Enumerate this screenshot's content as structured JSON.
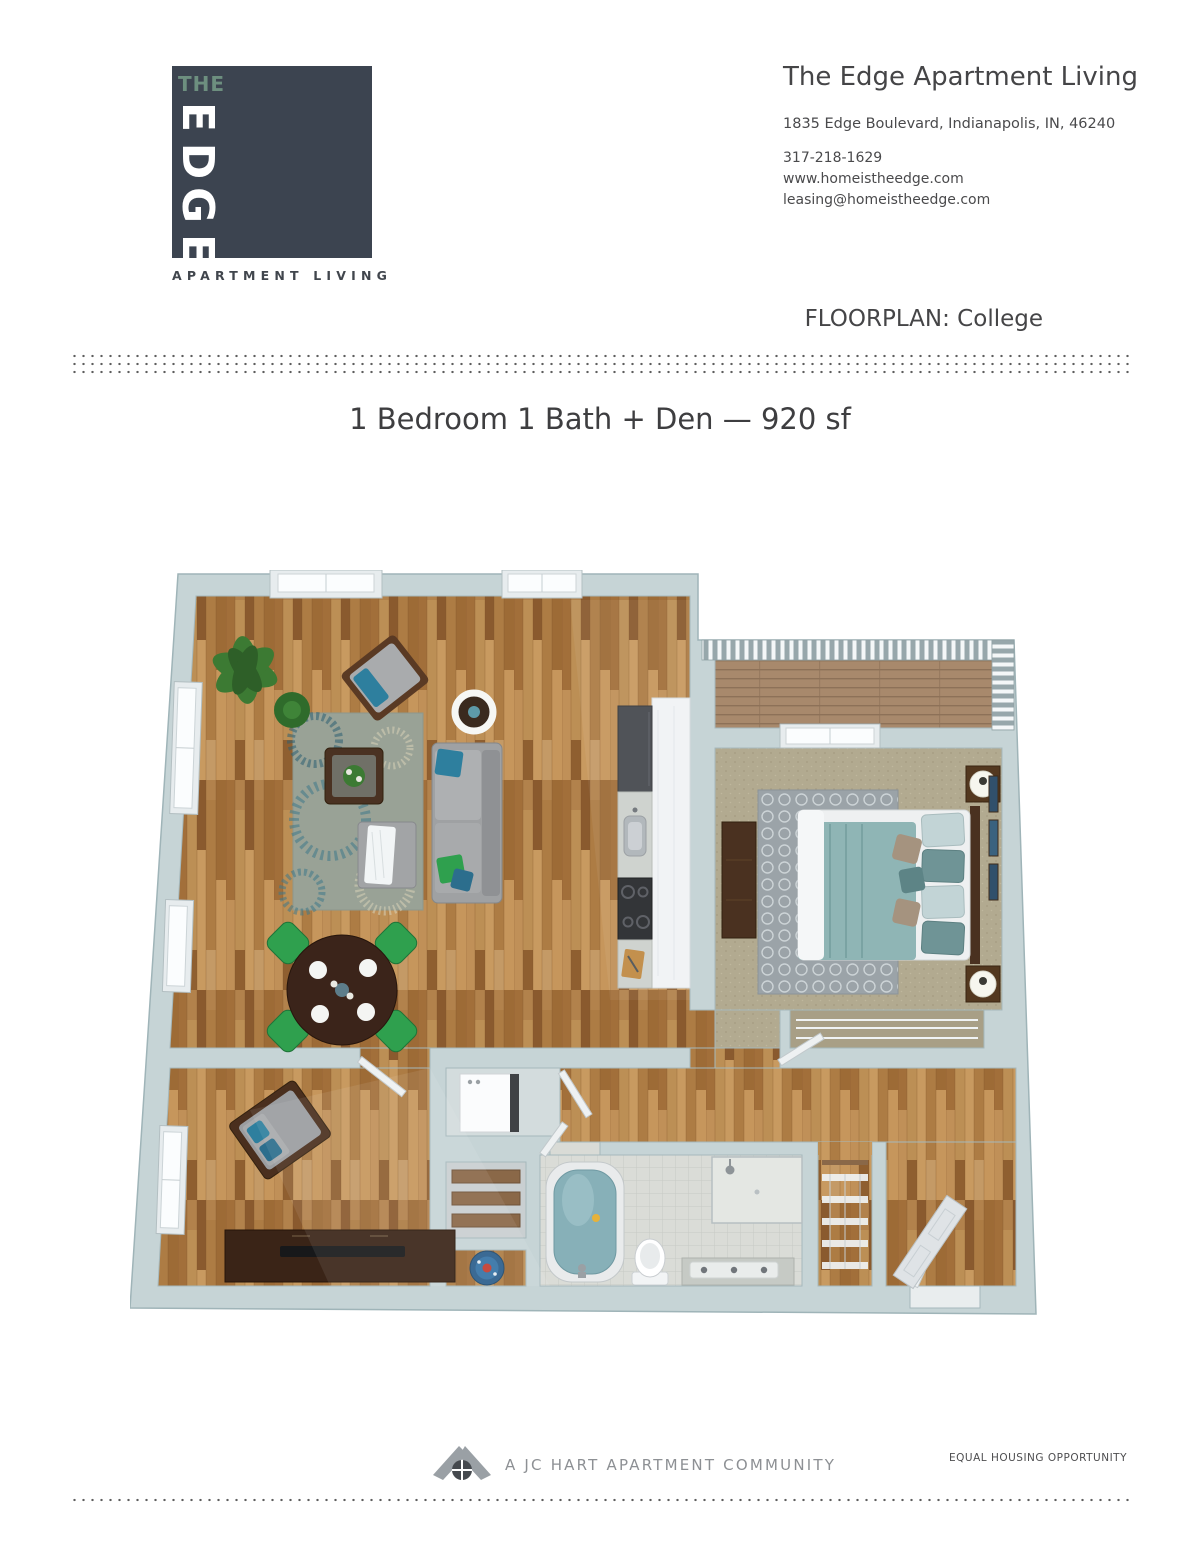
{
  "logo": {
    "the": "THE",
    "letters": [
      "E",
      "D",
      "G",
      "E"
    ],
    "tagline": "APARTMENT LIVING",
    "square_color": "#3c4450",
    "the_color": "#6d8f7f"
  },
  "header": {
    "title": "The Edge Apartment Living",
    "address": "1835 Edge Boulevard, Indianapolis, IN, 46240",
    "phone": "317-218-1629",
    "website": "www.homeistheedge.com",
    "email": "leasing@homeistheedge.com"
  },
  "floorplan": {
    "label": "FLOORPLAN: College",
    "title": "1 Bedroom 1 Bath + Den — 920 sf"
  },
  "footer": {
    "community": "A JC HART APARTMENT COMMUNITY",
    "equal_housing": "EQUAL HOUSING OPPORTUNITY"
  },
  "colors": {
    "brand_charcoal": "#3c4450",
    "brand_sage": "#6d8f7f",
    "wall": "#c6d4d6",
    "wood_floor": "#b2824c",
    "carpet": "#b2aa90",
    "accent_teal": "#2e7f9e",
    "accent_green": "#2fa04e",
    "body_text": "#4a4a4c",
    "footer_gray": "#8d9094"
  }
}
